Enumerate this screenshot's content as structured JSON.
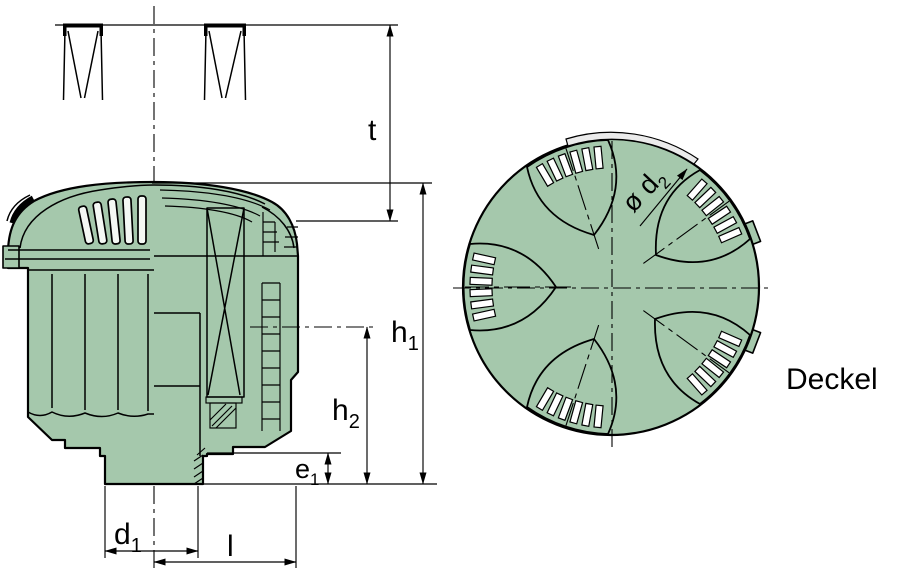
{
  "drawing": {
    "dimension_labels": {
      "t": {
        "base": "t",
        "sub": ""
      },
      "h1": {
        "base": "h",
        "sub": "1"
      },
      "h2": {
        "base": "h",
        "sub": "2"
      },
      "e1": {
        "base": "e",
        "sub": "1"
      },
      "d1": {
        "base": "d",
        "sub": "1"
      },
      "l": {
        "base": "l",
        "sub": ""
      },
      "d2": {
        "base": "ø d",
        "sub": "2"
      }
    },
    "annotations": {
      "top_view_caption": "Deckel"
    },
    "colors": {
      "part_fill": "#a5c8ac",
      "rim_highlight": "#ebebeb",
      "line": "#000000",
      "background": "#ffffff"
    }
  }
}
